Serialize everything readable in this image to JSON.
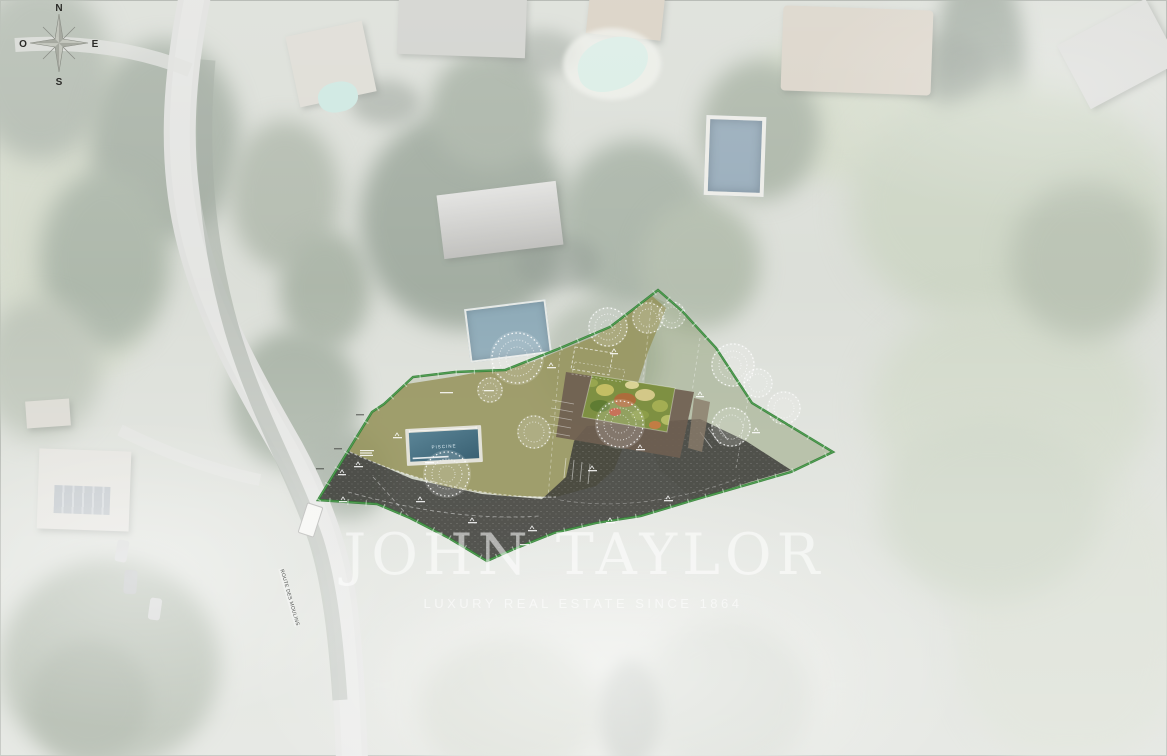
{
  "scene": {
    "type": "aerial-site-plan",
    "description": "Washed-out aerial photograph of a hillside residential area with a landscaped property site plan overlaid in the centre"
  },
  "compass": {
    "n": "N",
    "e": "E",
    "s": "S",
    "o": "O"
  },
  "watermark": {
    "brand": "JOHN TAYLOR",
    "tagline": "LUXURY REAL ESTATE SINCE 1864"
  },
  "road_label": "ROUTE DES MOULINS",
  "plan": {
    "pool_label": "PISCINE",
    "colors": {
      "boundary_green": "#2f7c33",
      "lawn_olive": "#96945c",
      "driveway_dark": "#3d3d39",
      "terrace_brown": "#6f6051",
      "green_roof": "#7e9042",
      "pool_water": "#49768a",
      "tree_sketch": "#ffffff"
    },
    "features": {
      "pool": "rectangular swimming pool",
      "building": "villa with vegetated green roof and surrounding terrace",
      "driveway": "dark gravel driveway with parking court",
      "trees_sketched": 12
    }
  },
  "vehicles": {
    "van": "white van on road",
    "parked_cars": 3
  }
}
